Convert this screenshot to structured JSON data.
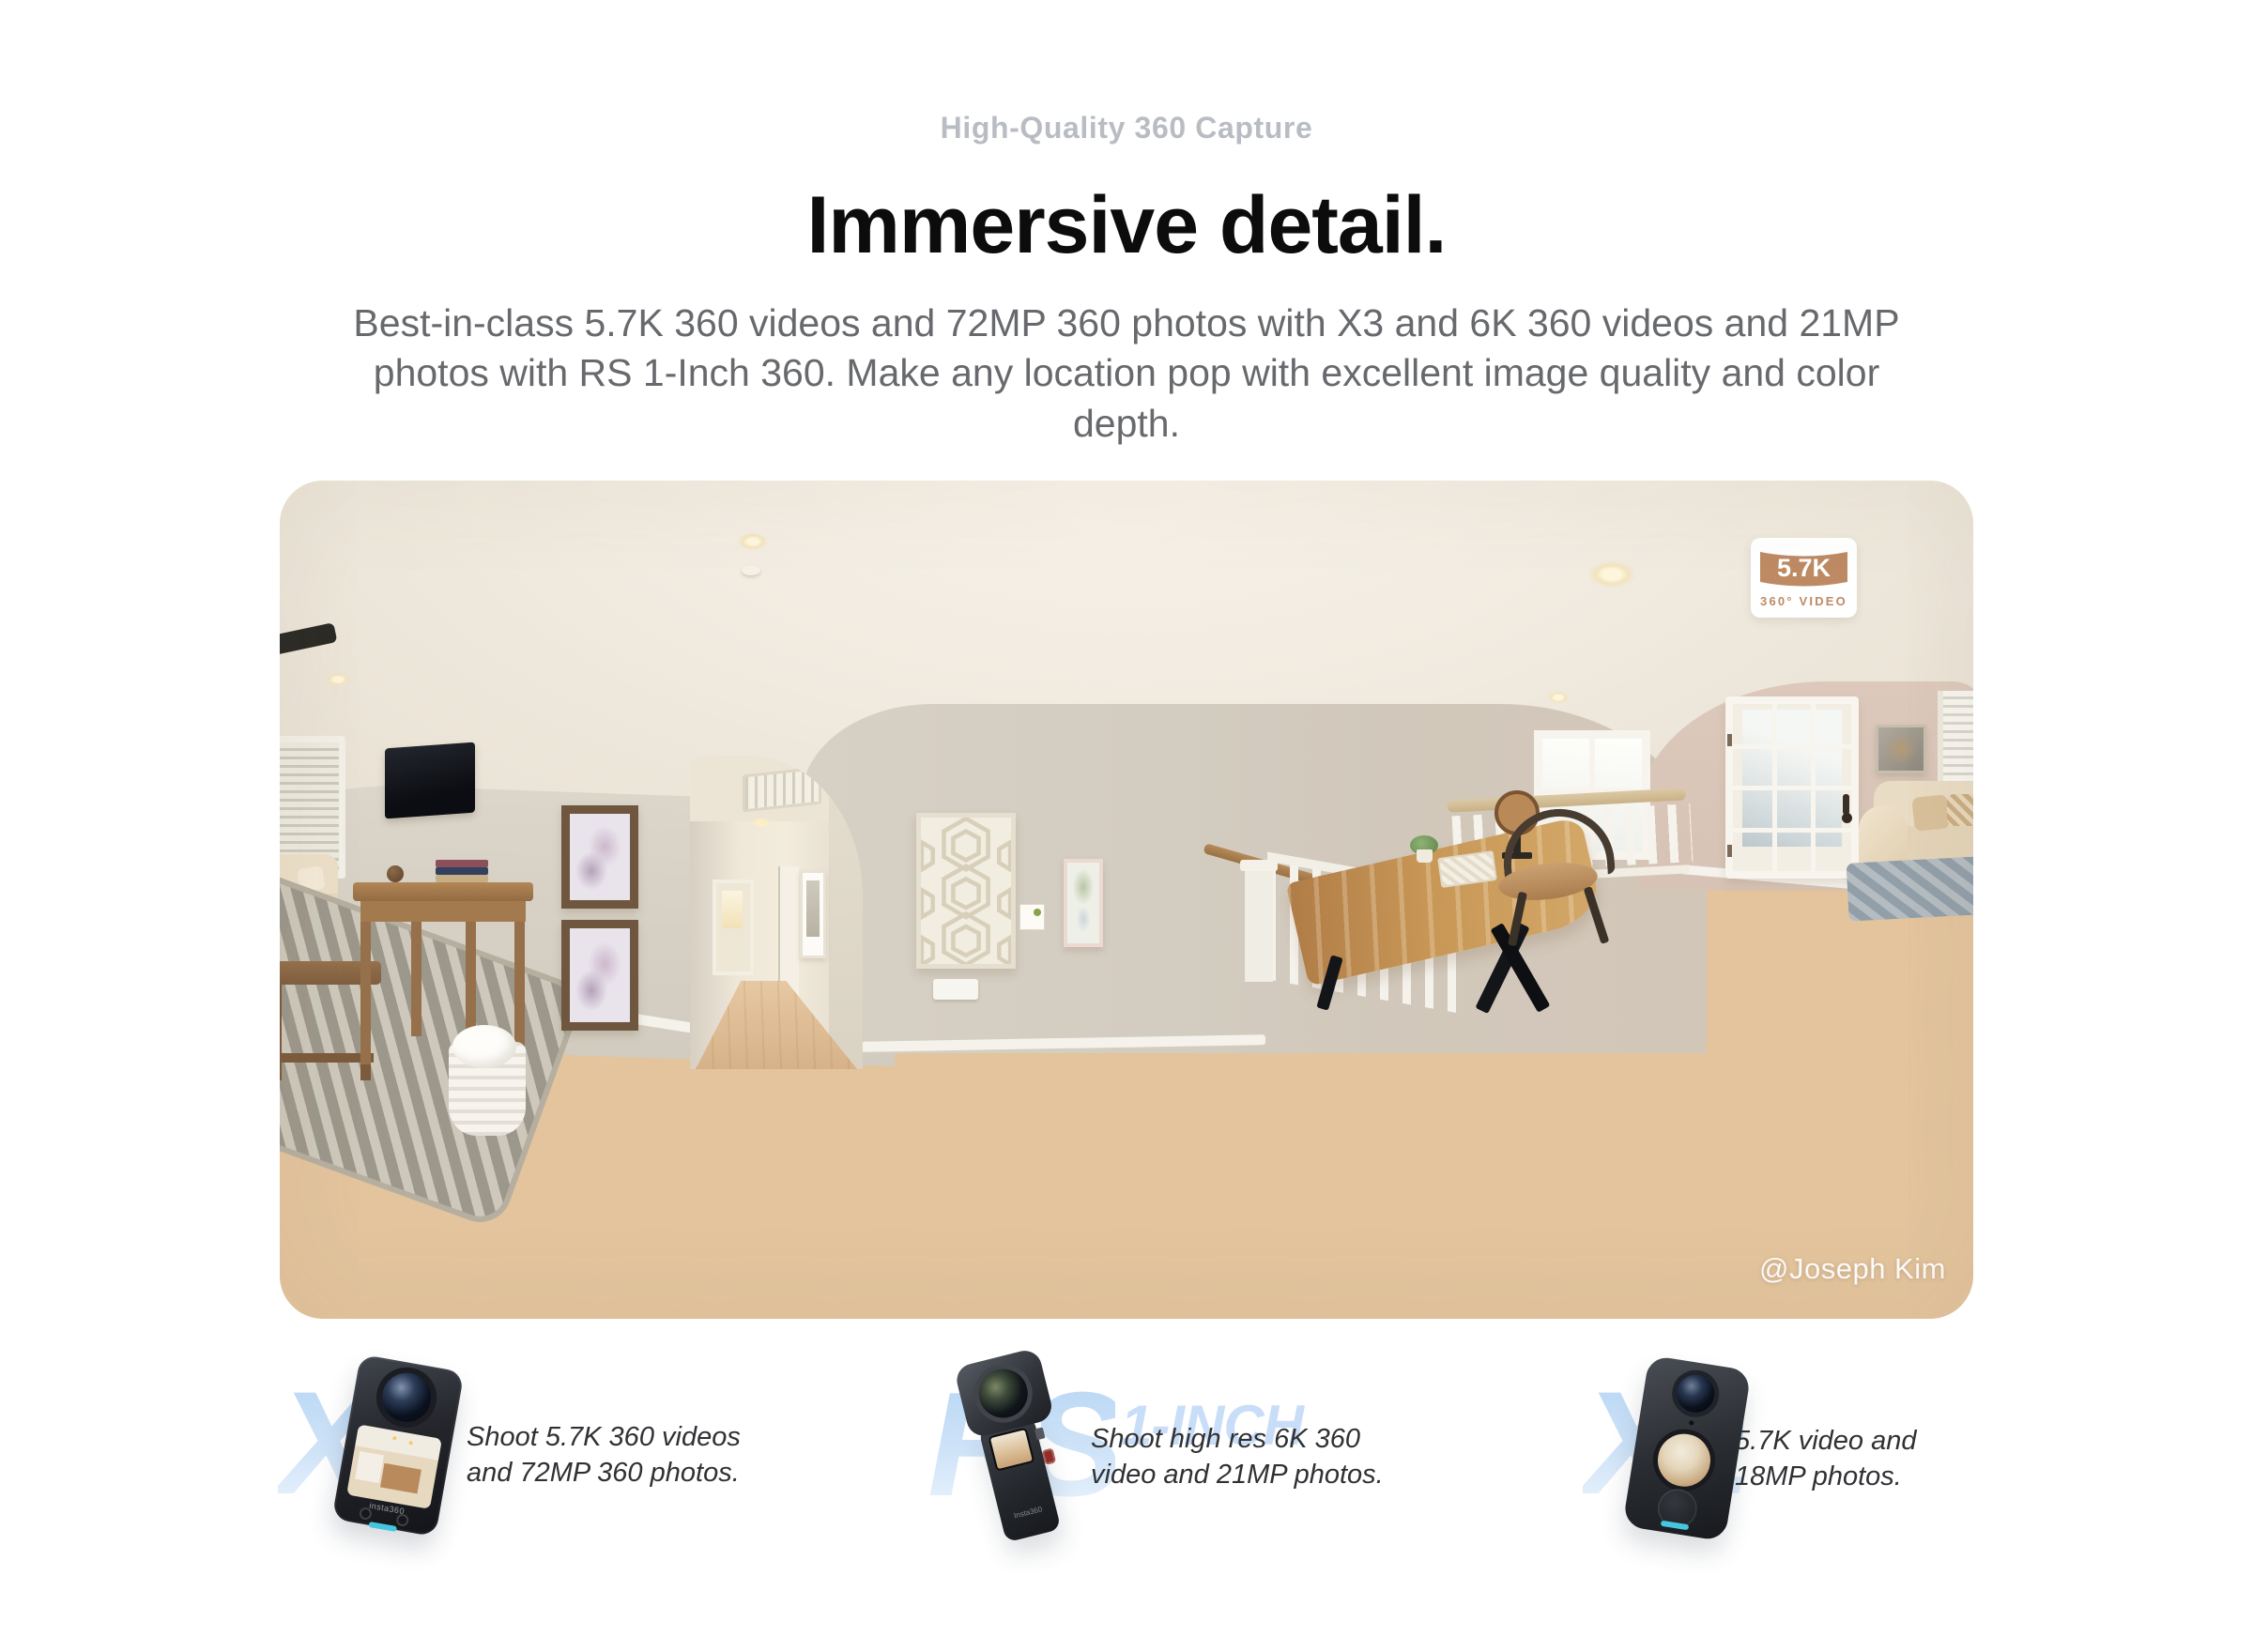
{
  "header": {
    "eyebrow": "High-Quality 360 Capture",
    "title": "Immersive detail.",
    "description": "Best-in-class 5.7K 360 videos and 72MP 360 photos with X3 and 6K 360 videos and 21MP photos with RS 1-Inch 360. Make any location pop with excellent image quality and color depth."
  },
  "hero": {
    "badge": {
      "resolution": "5.7K",
      "type_label": "360° VIDEO",
      "color": "#bd8a64"
    },
    "credit": "@Joseph Kim"
  },
  "products": [
    {
      "name": "X3",
      "watermark": "X3",
      "description": "Shoot 5.7K 360 videos and 72MP 360 photos.",
      "logo": "insta360"
    },
    {
      "name": "RS 1-Inch 360",
      "watermark": "RS",
      "watermark_suffix": "1-INCH",
      "description": "Shoot high res 6K 360 video and 21MP photos.",
      "logo": "Insta360"
    },
    {
      "name": "X2",
      "watermark": "X2",
      "description": "5.7K video and 18MP photos."
    }
  ],
  "colors": {
    "badge_tan": "#bd8a64",
    "watermark_blue_top": "#b7d6f4",
    "watermark_blue_bottom": "#ecf5fd",
    "accent_cyan": "#45c6de",
    "title_black": "#0c0c0d",
    "eyebrow_gray": "#b9bdc3",
    "body_gray": "#67696d"
  }
}
